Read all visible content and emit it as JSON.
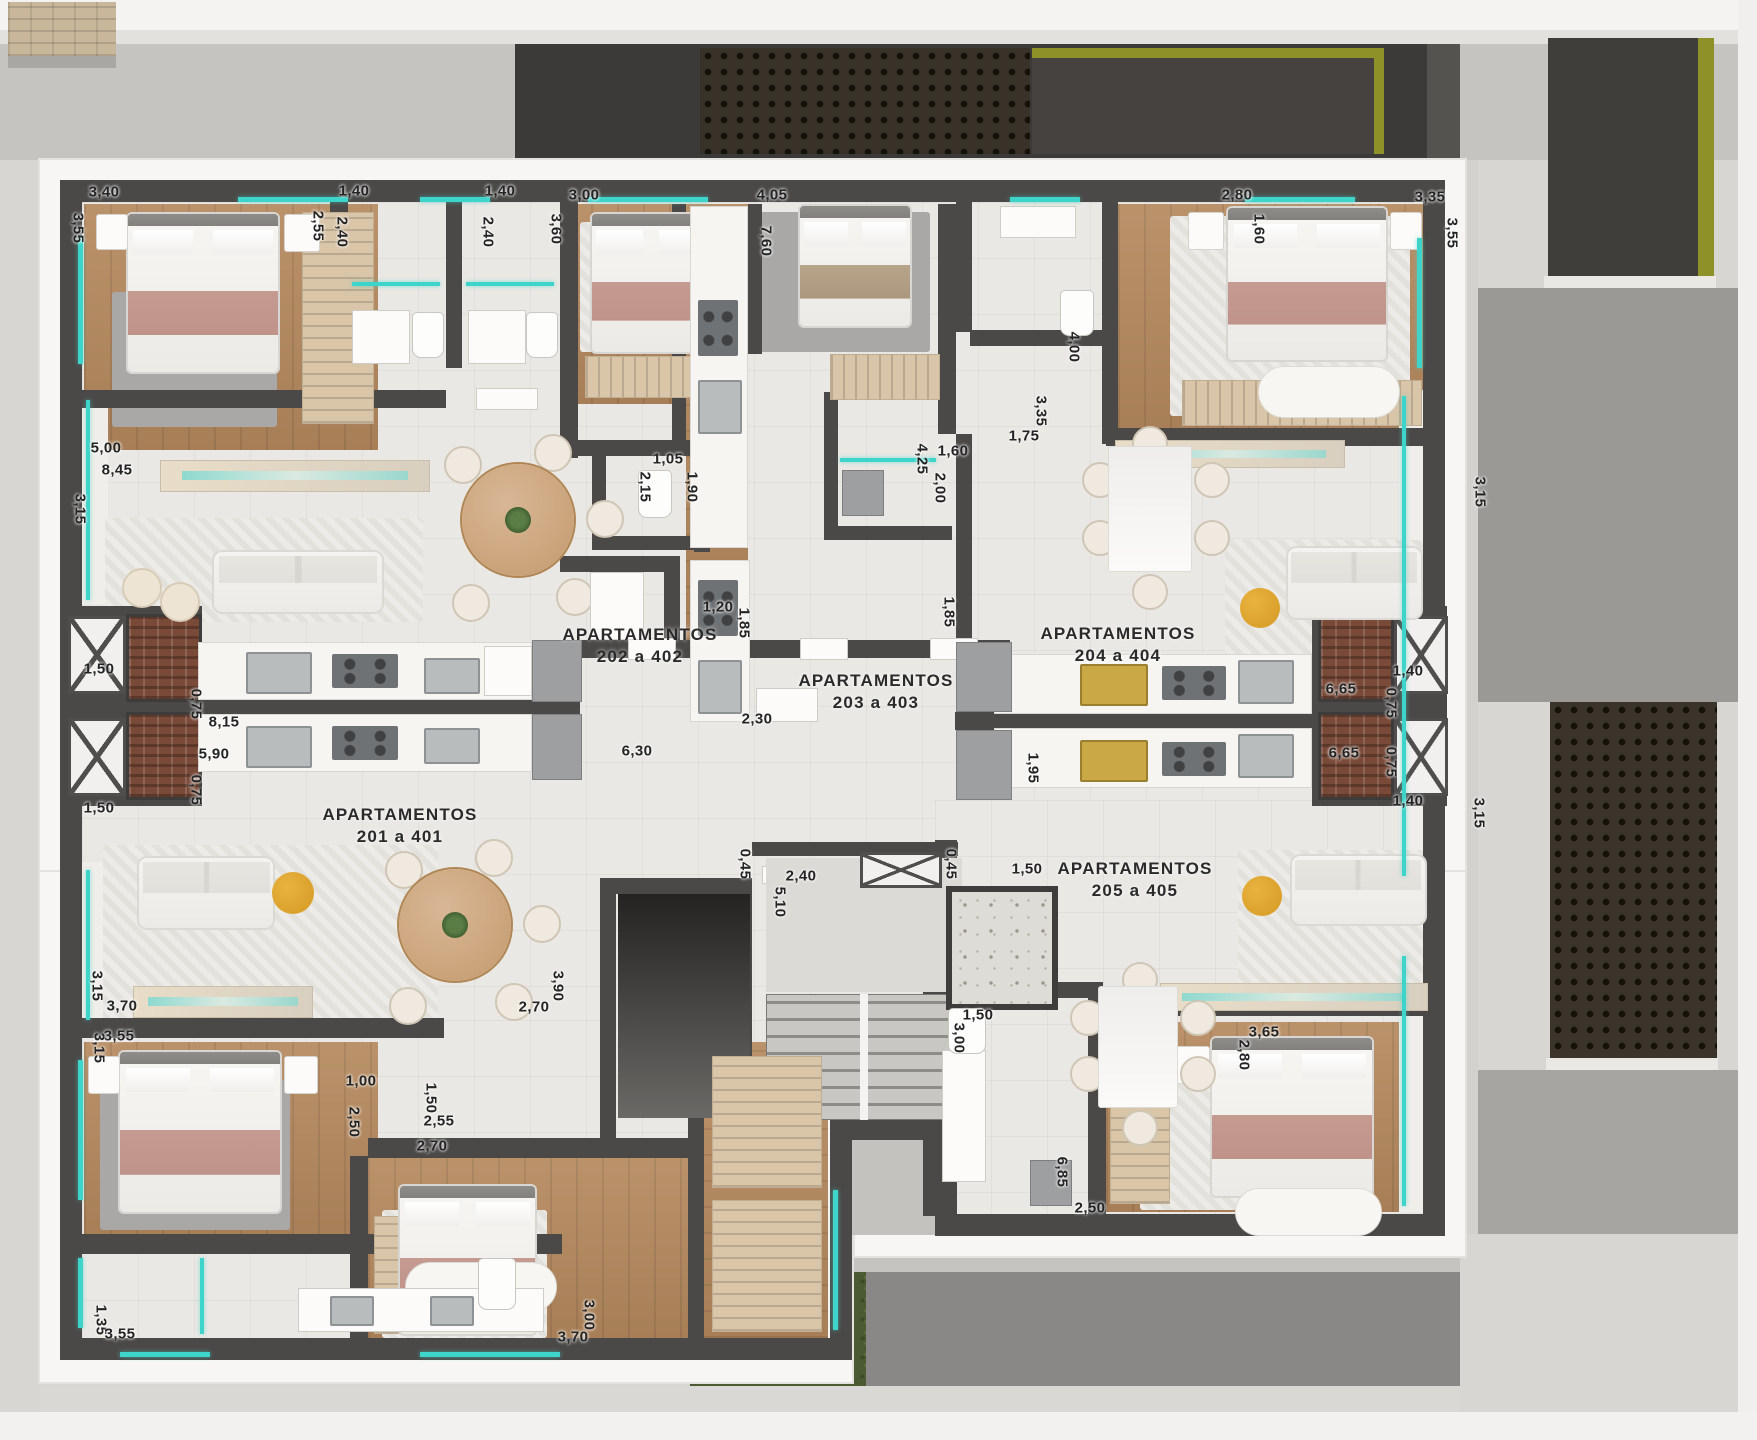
{
  "plan": {
    "type": "architectural-floor-plan",
    "floor_units_shown": [
      "201 a 401",
      "202 a 402",
      "203 a 403",
      "204 a 404",
      "205 a 405"
    ],
    "apartments": [
      {
        "title": "APARTAMENTOS",
        "range": "202 a 402",
        "x": 640,
        "y": 646
      },
      {
        "title": "APARTAMENTOS",
        "range": "203 a 403",
        "x": 876,
        "y": 692
      },
      {
        "title": "APARTAMENTOS",
        "range": "204 a 404",
        "x": 1118,
        "y": 645
      },
      {
        "title": "APARTAMENTOS",
        "range": "201 a 401",
        "x": 400,
        "y": 826
      },
      {
        "title": "APARTAMENTOS",
        "range": "205 a 405",
        "x": 1135,
        "y": 880
      }
    ],
    "dimensions": [
      {
        "t": "3,40",
        "x": 104,
        "y": 192,
        "r": 0
      },
      {
        "t": "3,55",
        "x": 78,
        "y": 228,
        "r": 1
      },
      {
        "t": "2,55",
        "x": 318,
        "y": 226,
        "r": 1
      },
      {
        "t": "1,40",
        "x": 354,
        "y": 191,
        "r": 0
      },
      {
        "t": "2,40",
        "x": 342,
        "y": 232,
        "r": 1
      },
      {
        "t": "1,40",
        "x": 500,
        "y": 191,
        "r": 0
      },
      {
        "t": "2,40",
        "x": 488,
        "y": 232,
        "r": 1
      },
      {
        "t": "3,60",
        "x": 556,
        "y": 229,
        "r": 1
      },
      {
        "t": "3,00",
        "x": 584,
        "y": 195,
        "r": 0
      },
      {
        "t": "4,05",
        "x": 772,
        "y": 195,
        "r": 0
      },
      {
        "t": "7,60",
        "x": 766,
        "y": 241,
        "r": 1
      },
      {
        "t": "2,80",
        "x": 1237,
        "y": 195,
        "r": 0
      },
      {
        "t": "1,60",
        "x": 1259,
        "y": 229,
        "r": 1
      },
      {
        "t": "3,35",
        "x": 1430,
        "y": 197,
        "r": 0
      },
      {
        "t": "3,55",
        "x": 1452,
        "y": 233,
        "r": 1
      },
      {
        "t": "5,00",
        "x": 106,
        "y": 448,
        "r": 0
      },
      {
        "t": "8,45",
        "x": 117,
        "y": 470,
        "r": 0
      },
      {
        "t": "3,15",
        "x": 80,
        "y": 509,
        "r": 1
      },
      {
        "t": "2,15",
        "x": 645,
        "y": 487,
        "r": 1
      },
      {
        "t": "1,05",
        "x": 668,
        "y": 459,
        "r": 0
      },
      {
        "t": "1,90",
        "x": 692,
        "y": 487,
        "r": 1
      },
      {
        "t": "1,20",
        "x": 718,
        "y": 607,
        "r": 0
      },
      {
        "t": "1,85",
        "x": 744,
        "y": 623,
        "r": 1
      },
      {
        "t": "4,25",
        "x": 922,
        "y": 459,
        "r": 1
      },
      {
        "t": "1,60",
        "x": 953,
        "y": 451,
        "r": 0
      },
      {
        "t": "2,00",
        "x": 940,
        "y": 488,
        "r": 1
      },
      {
        "t": "1,85",
        "x": 949,
        "y": 612,
        "r": 1
      },
      {
        "t": "2,30",
        "x": 757,
        "y": 719,
        "r": 0
      },
      {
        "t": "4,00",
        "x": 1074,
        "y": 347,
        "r": 1
      },
      {
        "t": "3,35",
        "x": 1041,
        "y": 411,
        "r": 1
      },
      {
        "t": "1,75",
        "x": 1024,
        "y": 436,
        "r": 0
      },
      {
        "t": "3,15",
        "x": 1480,
        "y": 492,
        "r": 1
      },
      {
        "t": "1,95",
        "x": 1033,
        "y": 768,
        "r": 1
      },
      {
        "t": "1,40",
        "x": 1408,
        "y": 671,
        "r": 0
      },
      {
        "t": "0,75",
        "x": 1391,
        "y": 703,
        "r": 1
      },
      {
        "t": "6,65",
        "x": 1341,
        "y": 689,
        "r": 0
      },
      {
        "t": "6,65",
        "x": 1344,
        "y": 753,
        "r": 0
      },
      {
        "t": "0,75",
        "x": 1391,
        "y": 762,
        "r": 1
      },
      {
        "t": "1,40",
        "x": 1408,
        "y": 801,
        "r": 0
      },
      {
        "t": "3,15",
        "x": 1479,
        "y": 813,
        "r": 1
      },
      {
        "t": "1,50",
        "x": 99,
        "y": 669,
        "r": 0
      },
      {
        "t": "0,75",
        "x": 196,
        "y": 704,
        "r": 1
      },
      {
        "t": "8,15",
        "x": 224,
        "y": 722,
        "r": 0
      },
      {
        "t": "5,90",
        "x": 214,
        "y": 754,
        "r": 0
      },
      {
        "t": "0,75",
        "x": 196,
        "y": 790,
        "r": 1
      },
      {
        "t": "1,50",
        "x": 99,
        "y": 808,
        "r": 0
      },
      {
        "t": "6,30",
        "x": 637,
        "y": 751,
        "r": 0
      },
      {
        "t": "0,45",
        "x": 745,
        "y": 864,
        "r": 1
      },
      {
        "t": "2,40",
        "x": 801,
        "y": 876,
        "r": 0
      },
      {
        "t": "5,10",
        "x": 780,
        "y": 902,
        "r": 1
      },
      {
        "t": "0,45",
        "x": 951,
        "y": 864,
        "r": 1
      },
      {
        "t": "1,50",
        "x": 1027,
        "y": 869,
        "r": 0
      },
      {
        "t": "3,15",
        "x": 97,
        "y": 986,
        "r": 1
      },
      {
        "t": "3,70",
        "x": 122,
        "y": 1006,
        "r": 0
      },
      {
        "t": "3,90",
        "x": 558,
        "y": 986,
        "r": 1
      },
      {
        "t": "2,70",
        "x": 534,
        "y": 1007,
        "r": 0
      },
      {
        "t": "3,55",
        "x": 119,
        "y": 1036,
        "r": 0
      },
      {
        "t": "3,15",
        "x": 99,
        "y": 1048,
        "r": 1
      },
      {
        "t": "1,00",
        "x": 361,
        "y": 1081,
        "r": 0
      },
      {
        "t": "2,50",
        "x": 354,
        "y": 1122,
        "r": 1
      },
      {
        "t": "1,50",
        "x": 431,
        "y": 1098,
        "r": 1
      },
      {
        "t": "2,55",
        "x": 439,
        "y": 1121,
        "r": 0
      },
      {
        "t": "2,70",
        "x": 432,
        "y": 1146,
        "r": 0
      },
      {
        "t": "1,35",
        "x": 101,
        "y": 1320,
        "r": 1
      },
      {
        "t": "3,55",
        "x": 120,
        "y": 1334,
        "r": 0
      },
      {
        "t": "3,00",
        "x": 589,
        "y": 1315,
        "r": 1
      },
      {
        "t": "3,70",
        "x": 573,
        "y": 1337,
        "r": 0
      },
      {
        "t": "1,50",
        "x": 978,
        "y": 1015,
        "r": 0
      },
      {
        "t": "3,00",
        "x": 959,
        "y": 1038,
        "r": 1
      },
      {
        "t": "6,85",
        "x": 1062,
        "y": 1172,
        "r": 1
      },
      {
        "t": "2,50",
        "x": 1090,
        "y": 1208,
        "r": 0
      },
      {
        "t": "3,65",
        "x": 1264,
        "y": 1032,
        "r": 0
      },
      {
        "t": "2,80",
        "x": 1244,
        "y": 1055,
        "r": 1
      }
    ],
    "colors": {
      "wall": "#4b4947",
      "wood_floor": "#b5895e",
      "tile_floor": "#eae8e4",
      "window_accent": "#3fd4ca",
      "olive_accent": "#8e9128",
      "grass": "#4c5a33",
      "exterior_concrete": "#c6c4c0",
      "dark_panel": "#3c3a38",
      "blanket_pink": "#c59a90",
      "gold_sink": "#c9a845"
    }
  }
}
